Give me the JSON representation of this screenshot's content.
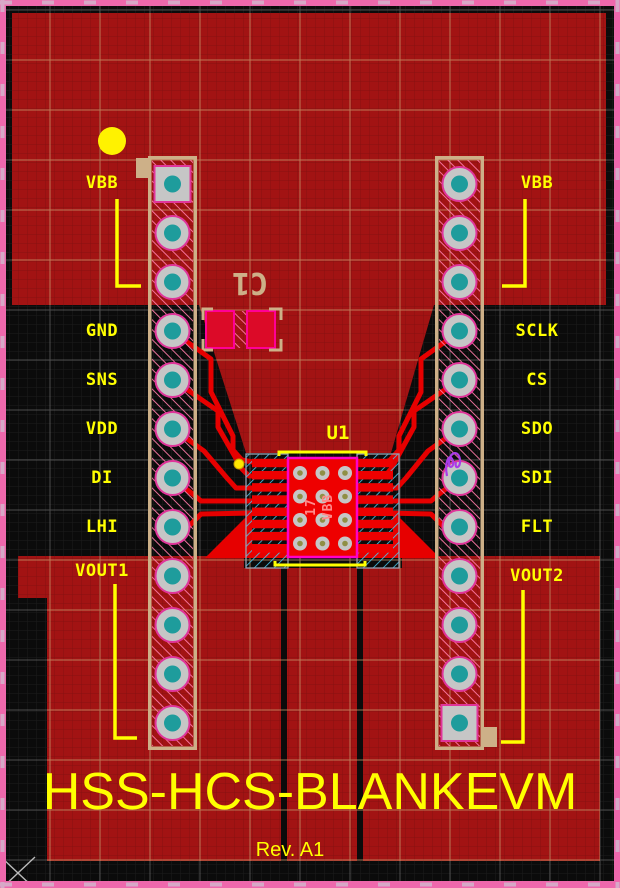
{
  "pcb": {
    "title": "HSS-HCS-BLANKEVM",
    "revision": "Rev. A1",
    "left_pin_labels": [
      "VBB",
      "GND",
      "SNS",
      "VDD",
      "DI",
      "LHI",
      "VOUT1"
    ],
    "right_pin_labels": [
      "VBB",
      "SCLK",
      "CS",
      "SDO",
      "SDI",
      "FLT",
      "VOUT2"
    ],
    "components": {
      "u1_refdes": "U1",
      "u1_pad_number": "17",
      "u1_pad_net": "VBB",
      "c1_refdes": "C1"
    },
    "headers": {
      "left_pins": 12,
      "right_pins": 12
    },
    "colors": {
      "copper_pour": "#A21313",
      "bright_copper": "#E60000",
      "component_pad_red": "#EE0000",
      "silkscreen_yellow": "#FFFF00",
      "board_outline_pink": "#EE68AC",
      "hatch_pink": "#FF7BA8",
      "courtyard_cyan": "#46C8F0",
      "pad_gray": "#C6C6C6",
      "drill_teal": "#1E9C9C",
      "mechanical_tan": "#CDB088",
      "pad_ring_magenta": "#E0359A",
      "u1_outline_magenta": "#FF00C8",
      "via_center_olive": "#8F8F45",
      "highlight_purple": "#A93BE8"
    }
  }
}
